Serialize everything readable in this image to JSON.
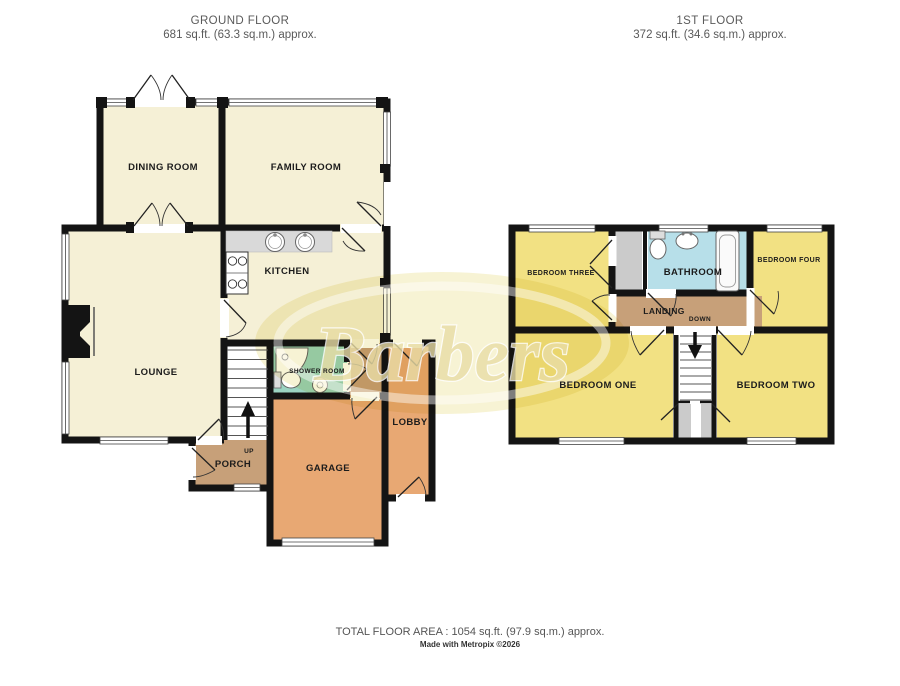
{
  "ground_floor": {
    "title": "GROUND FLOOR",
    "area": "681 sq.ft. (63.3 sq.m.) approx.",
    "rooms": {
      "dining": "DINING ROOM",
      "family": "FAMILY ROOM",
      "kitchen": "KITCHEN",
      "lounge": "LOUNGE",
      "shower": "SHOWER ROOM",
      "porch": "PORCH",
      "garage": "GARAGE",
      "lobby": "LOBBY",
      "stairs": "UP"
    }
  },
  "first_floor": {
    "title": "1ST FLOOR",
    "area": "372 sq.ft. (34.6 sq.m.) approx.",
    "rooms": {
      "bedroom_one": "BEDROOM ONE",
      "bedroom_two": "BEDROOM TWO",
      "bedroom_three": "BEDROOM THREE",
      "bedroom_four": "BEDROOM FOUR",
      "bathroom": "BATHROOM",
      "landing": "LANDING",
      "stairs": "DOWN"
    }
  },
  "footer": {
    "total_area": "TOTAL FLOOR AREA : 1054 sq.ft. (97.9 sq.m.) approx.",
    "credit": "Made with Metropix ©2026"
  },
  "watermark": {
    "text": "Barbers"
  },
  "colors": {
    "cream": "#f5f0d6",
    "yellow": "#f2e183",
    "orange": "#e8a873",
    "tan": "#c7a079",
    "teal": "#9bd3c2",
    "blue": "#b7dfe9",
    "gray": "#cbcbcb",
    "wall": "#141414",
    "watermark_fill": "#f7f2d0",
    "watermark_text": "#e9dda6"
  }
}
